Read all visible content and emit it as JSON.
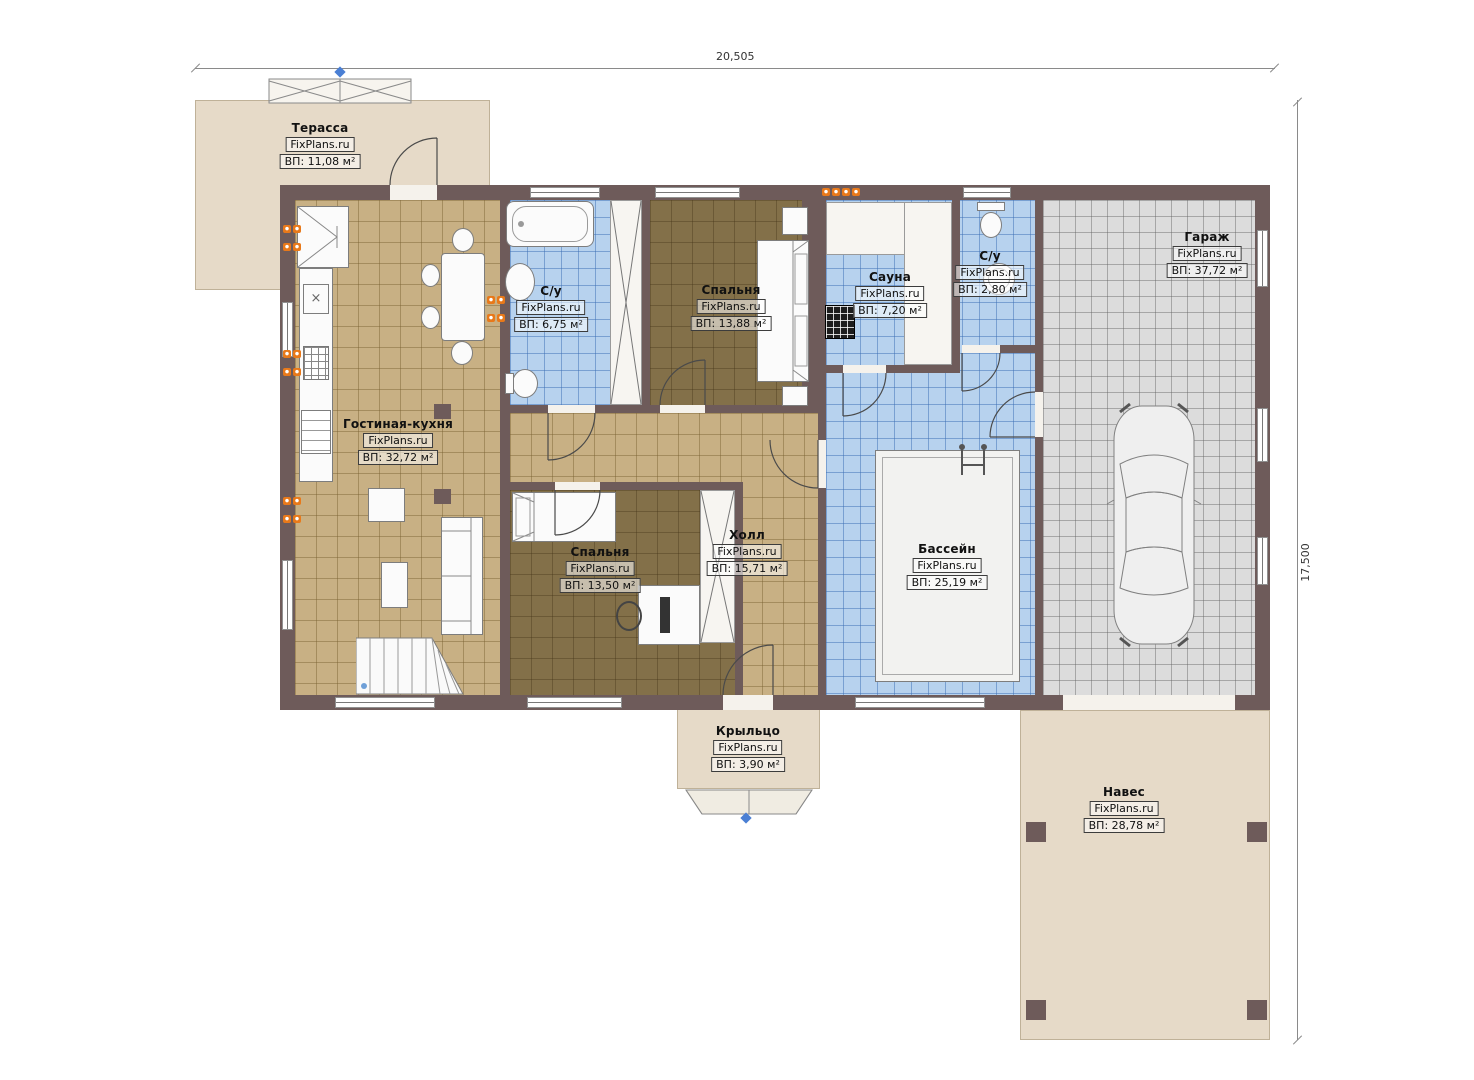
{
  "plan_title": "План первого этажа",
  "brand": "FixPlans.ru",
  "dimensions": {
    "overall_width": "20,505",
    "overall_height": "17,500"
  },
  "colors": {
    "wall": "#6e5b5a",
    "floor_living": "#c8b084",
    "floor_bedroom": "#837049",
    "floor_wet": "#b7d2ee",
    "floor_garage": "#dcdcdc",
    "outdoor": "#e6dac8",
    "marker_orange": "#e8791a",
    "marker_blue": "#4a7fd4"
  },
  "rooms": {
    "terrace": {
      "name": "Терасса",
      "area": "ВП: 11,08 м²"
    },
    "living_kitchen": {
      "name": "Гостиная-кухня",
      "area": "ВП: 32,72 м²"
    },
    "bathroom_main": {
      "name": "С/у",
      "area": "ВП: 6,75 м²"
    },
    "bedroom_top": {
      "name": "Спальня",
      "area": "ВП: 13,88 м²"
    },
    "sauna": {
      "name": "Сауна",
      "area": "ВП: 7,20 м²"
    },
    "bathroom_small": {
      "name": "С/у",
      "area": "ВП: 2,80 м²"
    },
    "garage": {
      "name": "Гараж",
      "area": "ВП: 37,72 м²"
    },
    "bedroom_bottom": {
      "name": "Спальня",
      "area": "ВП: 13,50 м²"
    },
    "hall": {
      "name": "Холл",
      "area": "ВП: 15,71 м²"
    },
    "pool": {
      "name": "Бассейн",
      "area": "ВП: 25,19 м²"
    },
    "porch": {
      "name": "Крыльцо",
      "area": "ВП: 3,90 м²"
    },
    "canopy": {
      "name": "Навес",
      "area": "ВП: 28,78 м²"
    }
  }
}
